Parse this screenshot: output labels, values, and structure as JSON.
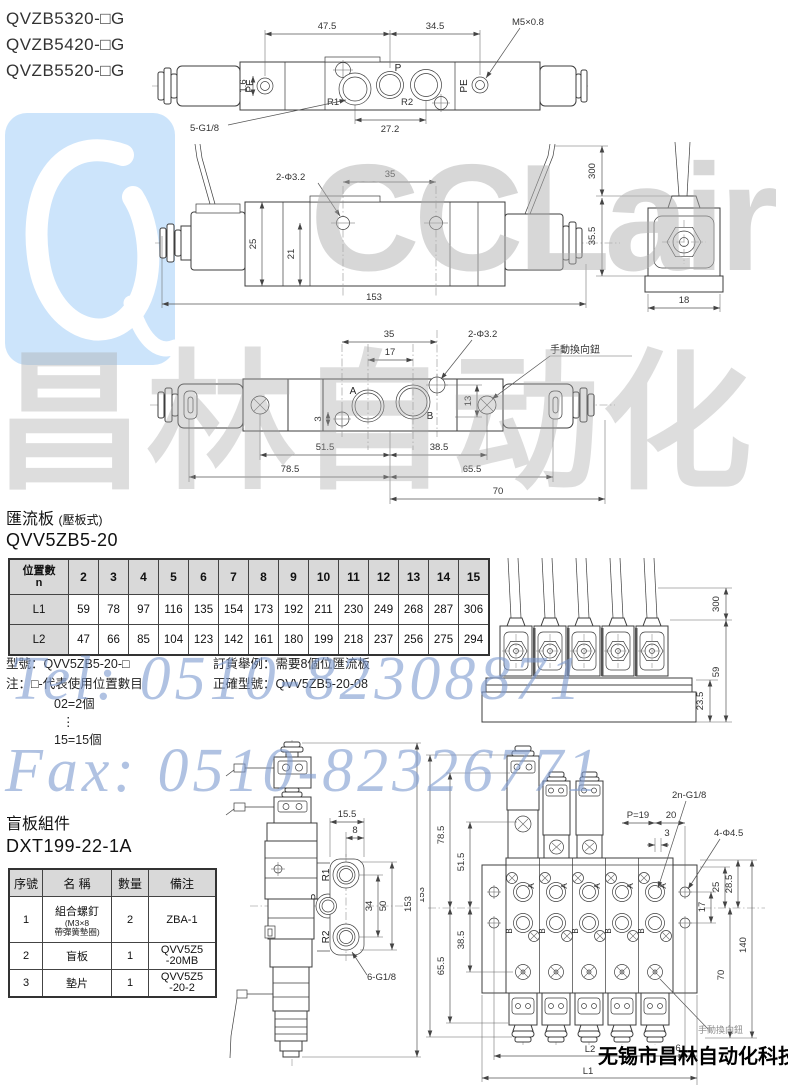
{
  "models": [
    "QVZB5320-□G",
    "QVZB5420-□G",
    "QVZB5520-□G"
  ],
  "d1": {
    "pe_l": "PE",
    "pe_r": "PE",
    "p": "P",
    "r1": "R1",
    "r2": "R2",
    "dim_a": "47.5",
    "dim_b": "34.5",
    "thread": "M5×0.8",
    "dim_c": "1.6",
    "ports": "5-G1/8",
    "dim_d": "27.2"
  },
  "d2": {
    "holes": "2-Φ3.2",
    "dim_35": "35",
    "dim_25": "25",
    "dim_21": "21",
    "dim_153": "153",
    "dim_300": "300",
    "dim_355": "35.5",
    "dim_18": "18"
  },
  "d3": {
    "dim_35": "35",
    "dim_17": "17",
    "holes": "2-Φ3.2",
    "manual": "手動換向鈕",
    "a": "A",
    "b": "B",
    "dim_3": "3",
    "dim_13": "13",
    "dim_515": "51.5",
    "dim_385": "38.5",
    "dim_785": "78.5",
    "dim_655": "65.5",
    "dim_70": "70"
  },
  "d4": {
    "dim_300": "300",
    "dim_59": "59",
    "dim_235": "23.5"
  },
  "d5": {
    "dim_155": "15.5",
    "dim_8": "8",
    "r1": "R1",
    "p": "P",
    "r2": "R2",
    "dim_34": "34",
    "dim_50": "50",
    "dim_153": "153",
    "ports": "6-G1/8"
  },
  "d6": {
    "dim_153": "153",
    "dim_785": "78.5",
    "dim_515": "51.5",
    "dim_655": "65.5",
    "dim_385": "38.5",
    "gport": "2n-G1/8",
    "p19": "P=19",
    "dim_20": "20",
    "dim_3": "3",
    "holes": "4-Φ4.5",
    "dim_25": "25",
    "dim_285": "28.5",
    "dim_17": "17",
    "dim_140": "140",
    "dim_70": "70",
    "l1": "L1",
    "l2": "L2",
    "dim_6": "6",
    "manual": "手動換向鈕",
    "a": "A",
    "b": "B"
  },
  "sec1": {
    "title": "匯流板",
    "suffix": "(壓板式)",
    "model": "QVV5ZB5-20"
  },
  "pt": {
    "h1": "位置數",
    "h2": "n",
    "pos": [
      "2",
      "3",
      "4",
      "5",
      "6",
      "7",
      "8",
      "9",
      "10",
      "11",
      "12",
      "13",
      "14",
      "15"
    ],
    "l1_label": "L1",
    "l1": [
      "59",
      "78",
      "97",
      "116",
      "135",
      "154",
      "173",
      "192",
      "211",
      "230",
      "249",
      "268",
      "287",
      "306"
    ],
    "l2_label": "L2",
    "l2": [
      "47",
      "66",
      "85",
      "104",
      "123",
      "142",
      "161",
      "180",
      "199",
      "218",
      "237",
      "256",
      "275",
      "294"
    ]
  },
  "notes": {
    "model_line": "型號：QVV5ZB5-20-□",
    "note_line": "注：□-代表使用位置數目",
    "ex_min": "02=2個",
    "dots": "⋮",
    "ex_max": "15=15個",
    "order1": "訂貨舉例：需要8個位匯流板",
    "order2": "正確型號：QVV5ZB5-20-08"
  },
  "sec2": {
    "title": "盲板組件",
    "model": "DXT199-22-1A"
  },
  "bt": {
    "h": [
      "序號",
      "名 稱",
      "數量",
      "備注"
    ],
    "r1": {
      "no": "1",
      "name": "組合螺釘",
      "sub": "(M3×8\n帶彈簧墊圈)",
      "qty": "2",
      "rem": "ZBA-1"
    },
    "r2": {
      "no": "2",
      "name": "盲板",
      "qty": "1",
      "rem": "QVV5Z5\n-20MB"
    },
    "r3": {
      "no": "3",
      "name": "墊片",
      "qty": "1",
      "rem": "QVV5Z5\n-20-2"
    }
  },
  "wm": {
    "logo": "CCLair",
    "cn": "昌林自动化",
    "tel": "Tel: 0510-82308871",
    "fax": "Fax: 0510-82326771",
    "company": "无锡市昌林自动化科技",
    "blue": "#7d9ad0",
    "gray": "#a8a8a8",
    "logo_bg": "#cce4fb"
  }
}
